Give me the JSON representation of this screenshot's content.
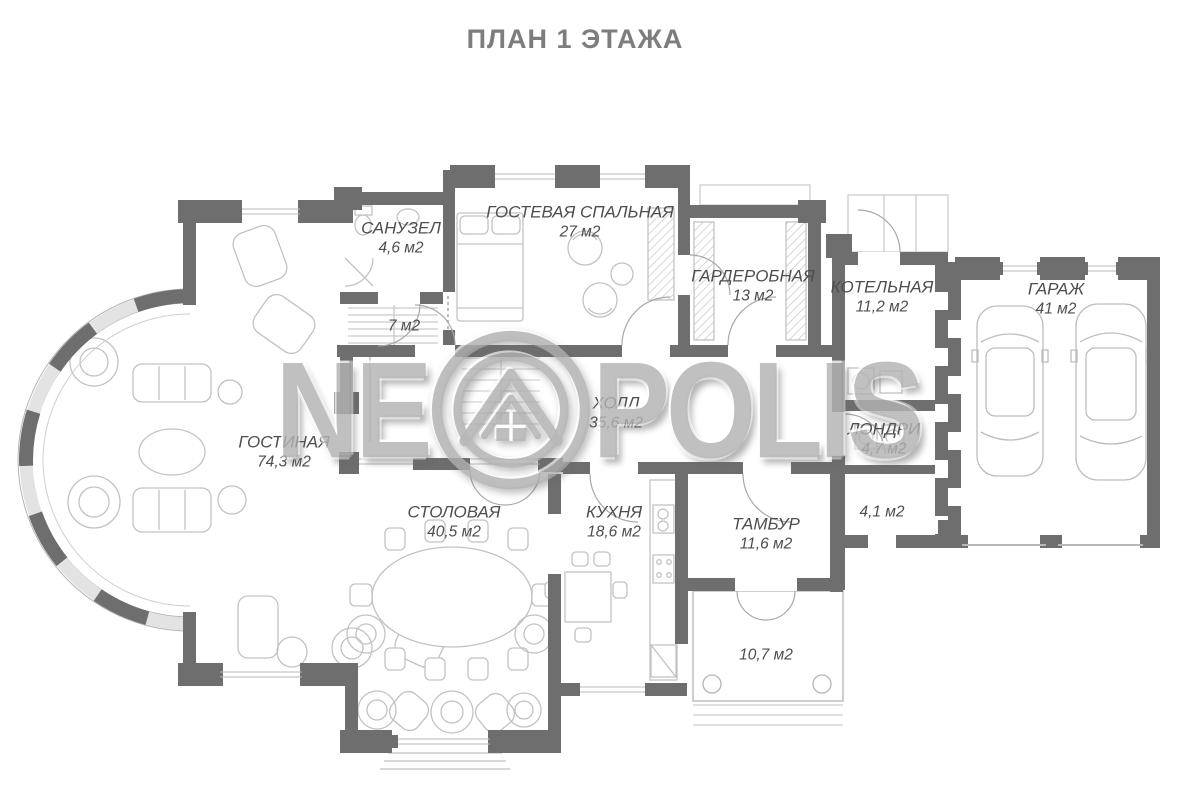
{
  "title": "ПЛАН 1 ЭТАЖА",
  "watermark": {
    "left": "NE",
    "right": "POLIS",
    "logo": "house-in-double-circle"
  },
  "rooms": [
    {
      "id": "sanuzel",
      "name": "САНУЗЕЛ",
      "area": "4,6 м2"
    },
    {
      "id": "room7",
      "name": "",
      "area": "7 м2"
    },
    {
      "id": "guestroom",
      "name": "ГОСТЕВАЯ СПАЛЬНАЯ",
      "area": "27 м2"
    },
    {
      "id": "wardrobe",
      "name": "ГАРДЕРОБНАЯ",
      "area": "13 м2"
    },
    {
      "id": "boiler",
      "name": "КОТЕЛЬНАЯ",
      "area": "11,2 м2"
    },
    {
      "id": "garage",
      "name": "ГАРАЖ",
      "area": "41 м2"
    },
    {
      "id": "hall",
      "name": "ХОЛЛ",
      "area": "35,6 м2"
    },
    {
      "id": "laundry",
      "name": "ЛОНДРИ",
      "area": "4,7 м2"
    },
    {
      "id": "living",
      "name": "ГОСТИНАЯ",
      "area": "74,3 м2"
    },
    {
      "id": "dining",
      "name": "СТОЛОВАЯ",
      "area": "40,5 м2"
    },
    {
      "id": "kitchen",
      "name": "КУХНЯ",
      "area": "18,6 м2"
    },
    {
      "id": "tambour",
      "name": "ТАМБУР",
      "area": "11,6 м2"
    },
    {
      "id": "corridor41",
      "name": "",
      "area": "4,1 м2"
    },
    {
      "id": "porch",
      "name": "",
      "area": "10,7 м2"
    }
  ],
  "colors": {
    "wall": "#6e6e6e",
    "furniture_line": "#c2c2c2",
    "window_line": "#b8b8b8",
    "label_text": "#4e4e4e",
    "title_text": "#7d7d7d",
    "watermark": "#a8a8a8"
  }
}
